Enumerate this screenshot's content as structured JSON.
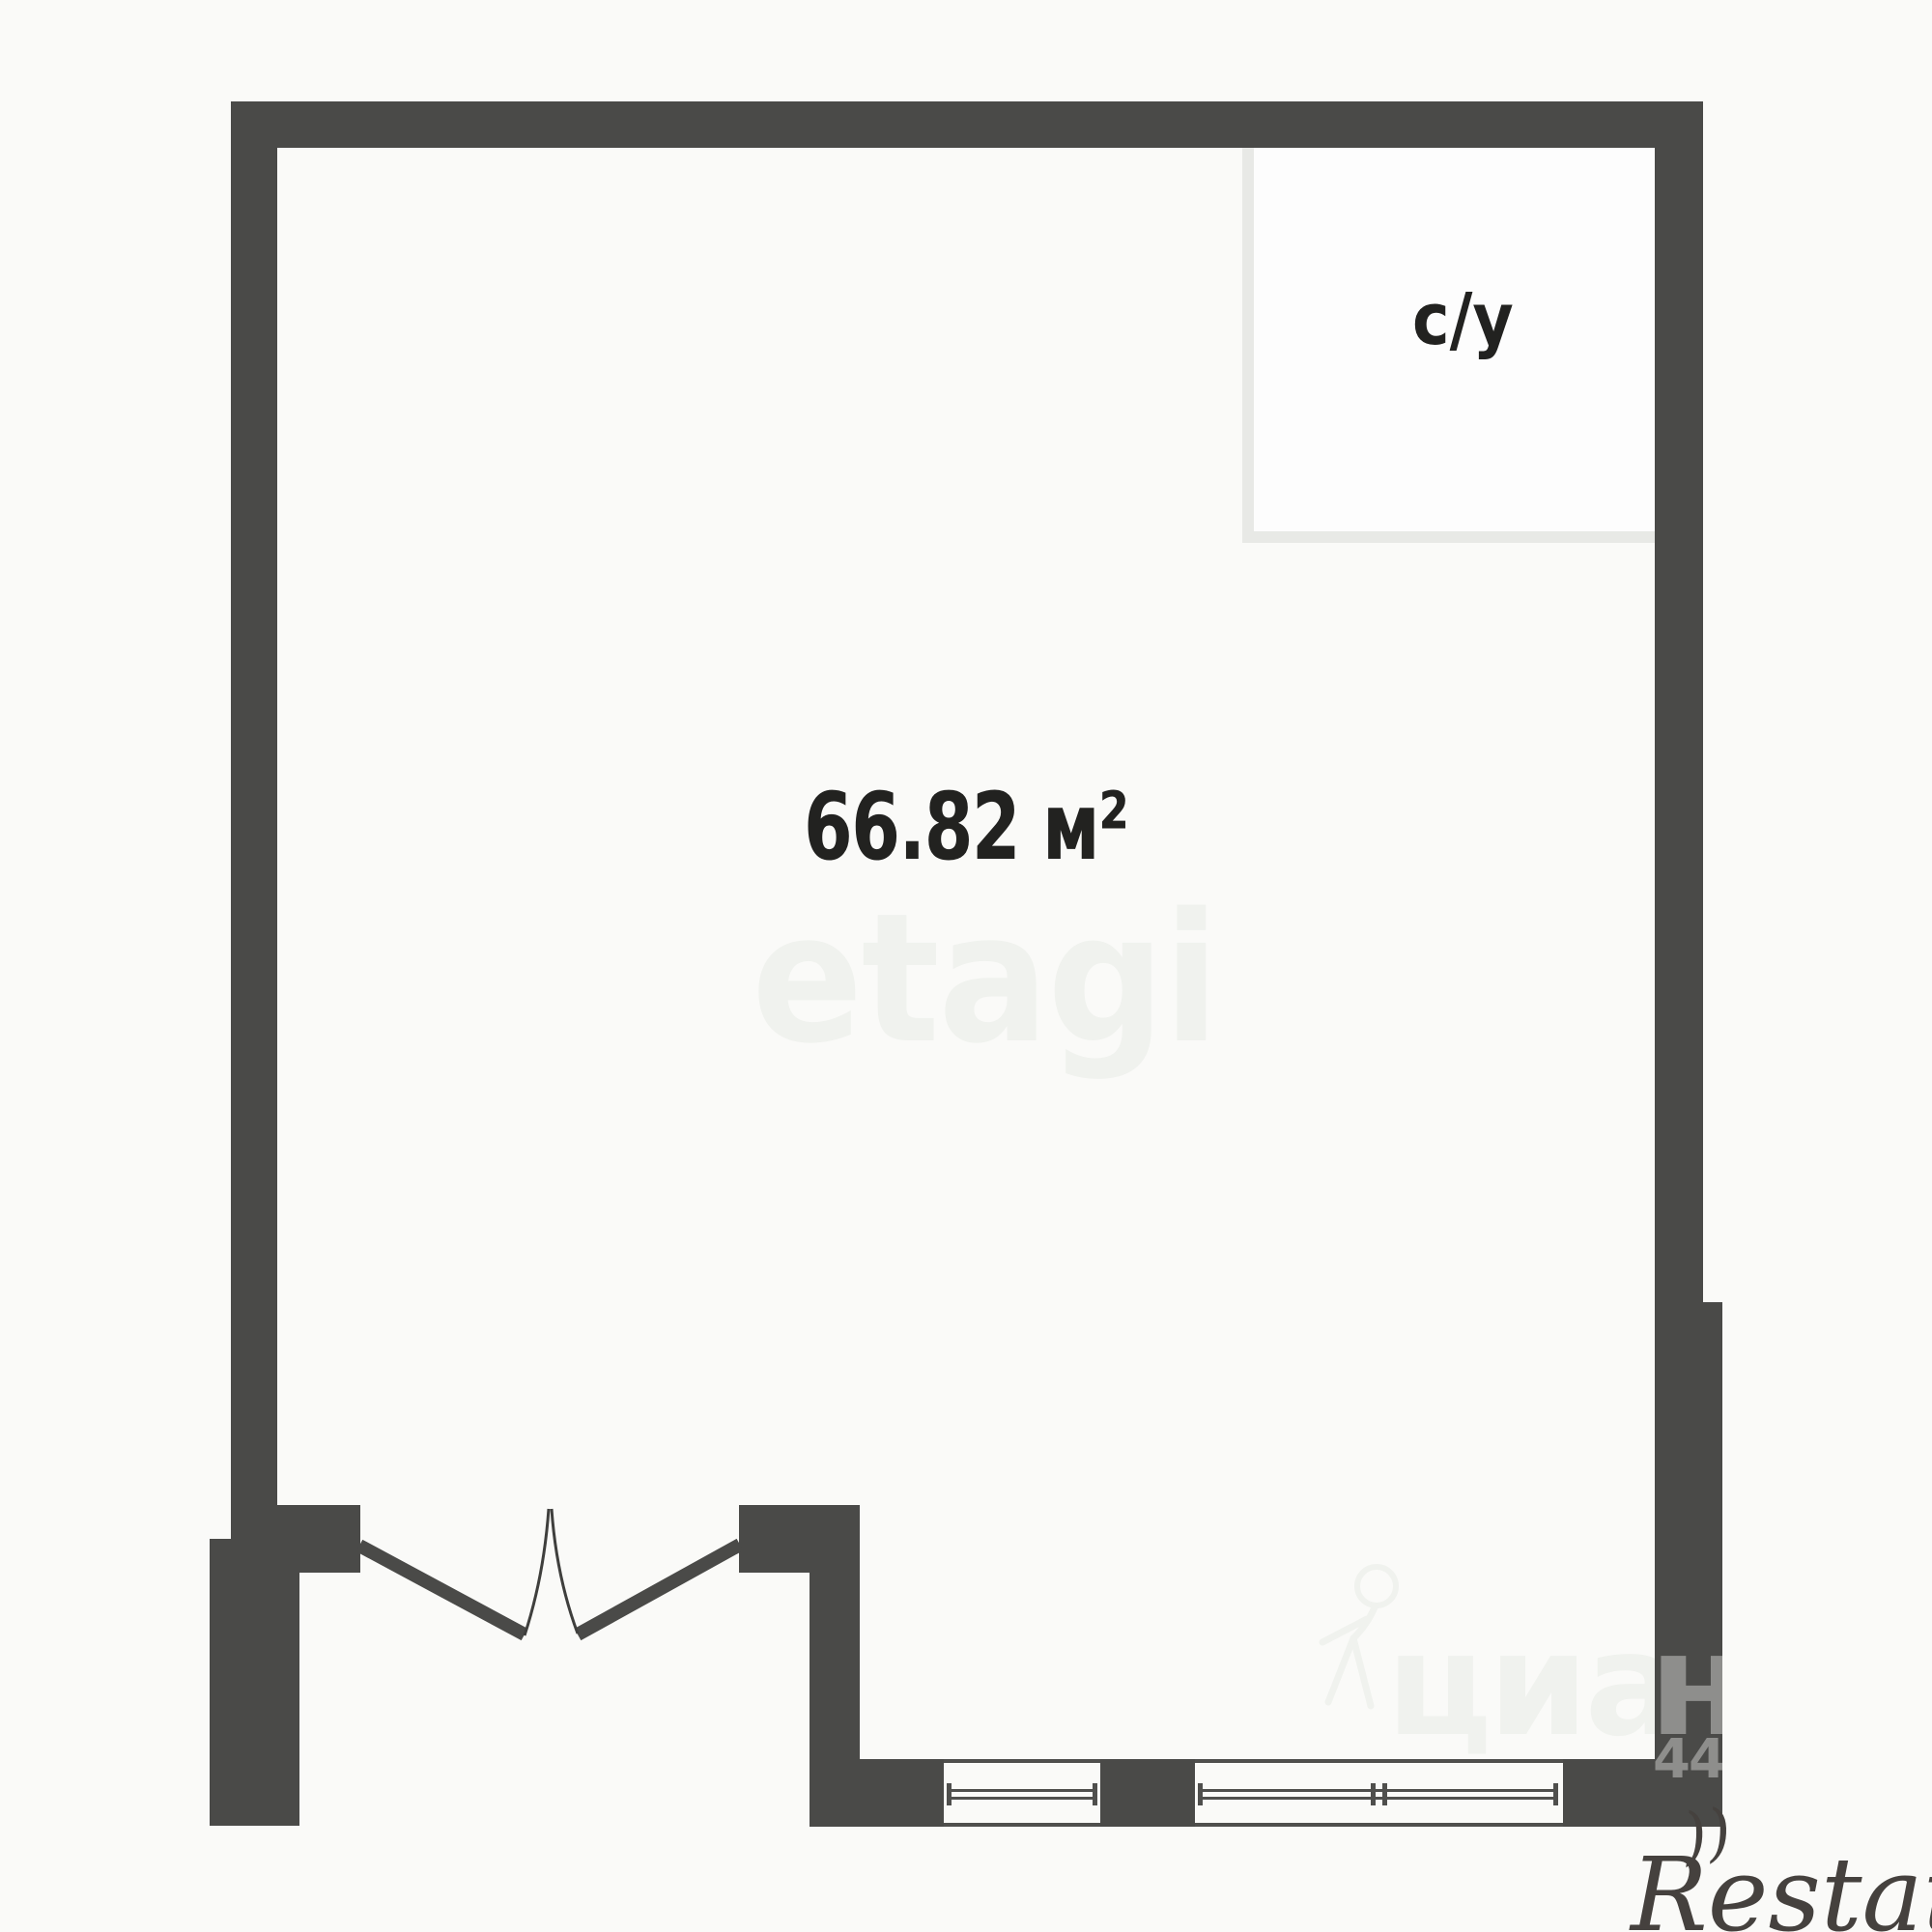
{
  "plan": {
    "rooms": {
      "main_room": {
        "area_label": "66.82 м²"
      },
      "bathroom": {
        "label": "с/у"
      }
    },
    "features": [
      "double-entry-door-with-swing-arcs",
      "two-windows-bottom-wall",
      "bathroom-partition-top-right"
    ]
  },
  "watermarks": {
    "etagi": "etagi",
    "cian_text": "циан",
    "cian_wall_letter": "н",
    "cian_digits": "440",
    "restate": "Restate",
    "restate_swash": "))"
  },
  "colors": {
    "bg": "#fafaf8",
    "wall": "#4a4a48",
    "partition": "#e8e9e6",
    "bath-floor": "#fdfdfd",
    "frame": "#4f4f4d",
    "arc": "#3f3f3d",
    "ink": "#222220",
    "wm-light": "#f0f2ee",
    "wm-gray": "#8e8e8c",
    "restate-ink": "#45413e"
  }
}
